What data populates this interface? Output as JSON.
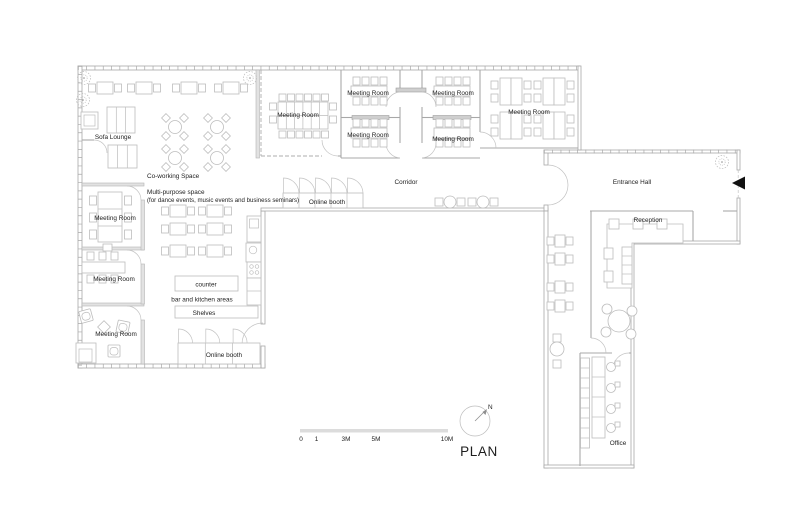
{
  "plan": {
    "title": "PLAN",
    "north": "N",
    "scale_labels": [
      "0",
      "1",
      "3M",
      "5M",
      "10M"
    ],
    "labels": {
      "sofa_lounge": "Sofa Lounge",
      "coworking": "Co-working Space",
      "multipurpose": "Multi-purpose space",
      "multipurpose_note": "(for dance events, music events and business seminars)",
      "meeting_room": "Meeting Room",
      "corridor": "Corridor",
      "online_booth": "Online booth",
      "entrance_hall": "Entrance Hall",
      "reception": "Reception",
      "office": "Office",
      "counter": "counter",
      "bar_kitchen": "bar and kitchen areas",
      "shelves": "Shelves"
    },
    "colors": {
      "wall": "#a8a8a8",
      "furniture_line": "#bdbdbd",
      "text": "#1d1d1d",
      "partition": "#cfcfcf",
      "hatch_wall": "#e2e2e2",
      "scale_bar": "#dcdcdc",
      "entrance_arrow": "#111111"
    }
  }
}
